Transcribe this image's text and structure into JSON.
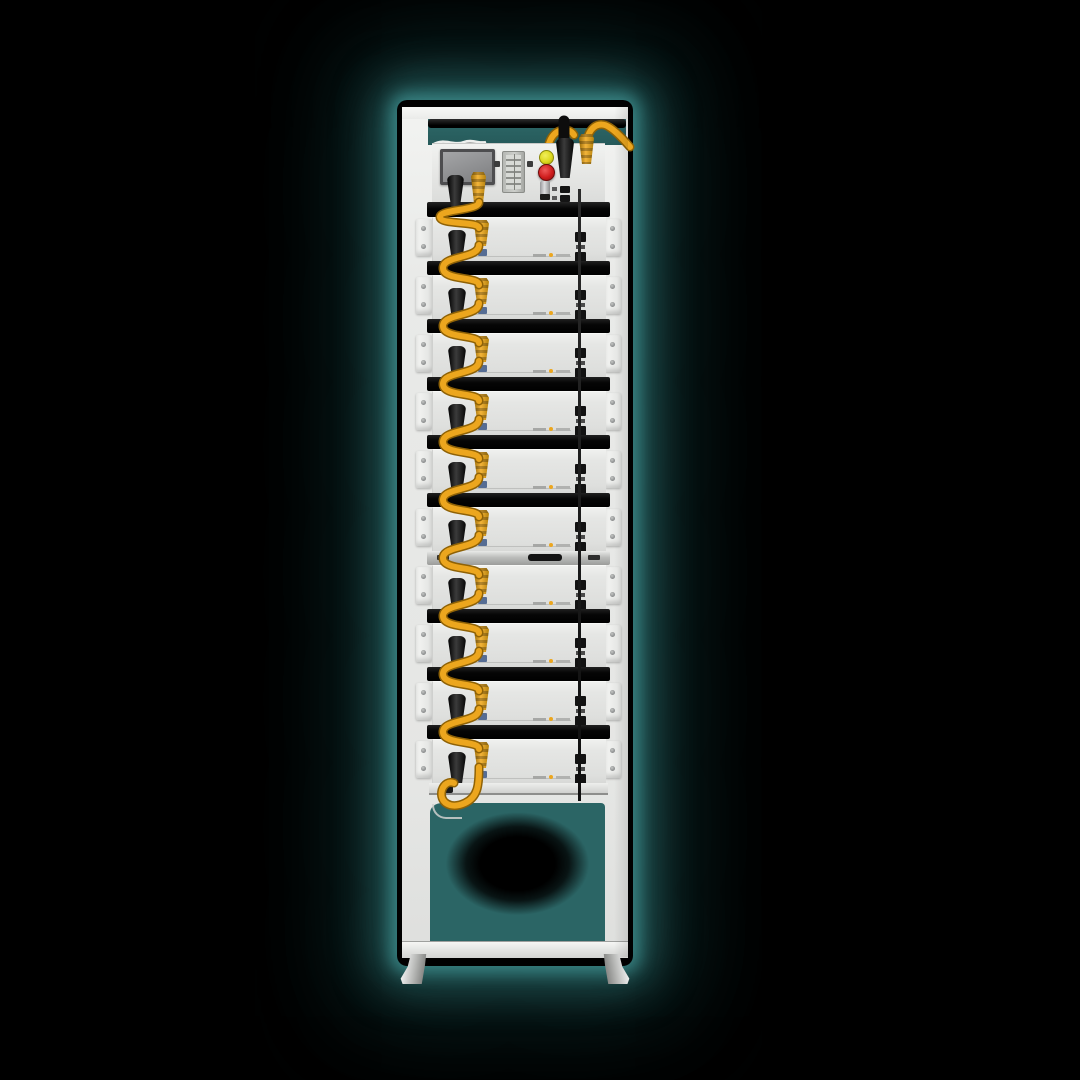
{
  "scene": {
    "background": "#000000",
    "glow_color": "#2e6b6b"
  },
  "rack": {
    "name": "stacked-high-voltage-battery-rack",
    "module_count": 10,
    "silver_handle_after_module": 6,
    "control_unit": {
      "components": [
        "display-screen",
        "terminal-block",
        "signal-lamp-yellow",
        "emergency-stop-button",
        "fuse-holder",
        "power-connector",
        "link-connector",
        "comm-ports"
      ]
    },
    "module": {
      "components": [
        "power-connector",
        "link-connector",
        "comm-port-upper",
        "comm-port-lower",
        "product-label",
        "mounting-ears"
      ]
    },
    "colors": {
      "frame_white": "#e9eae8",
      "separator": "#0b0b0b",
      "silver_bar": "#c2c3c1",
      "cable_yellow": "#eca61e",
      "cable_yellow_dark": "#8f6206",
      "connector_black": "#161616",
      "display_gray": "#8c8d8f",
      "button_red": "#cf1d1d",
      "button_yellow": "#dcd81e",
      "bay_teal": "#2b6565",
      "mini_logo_blue": "#47618c"
    }
  }
}
